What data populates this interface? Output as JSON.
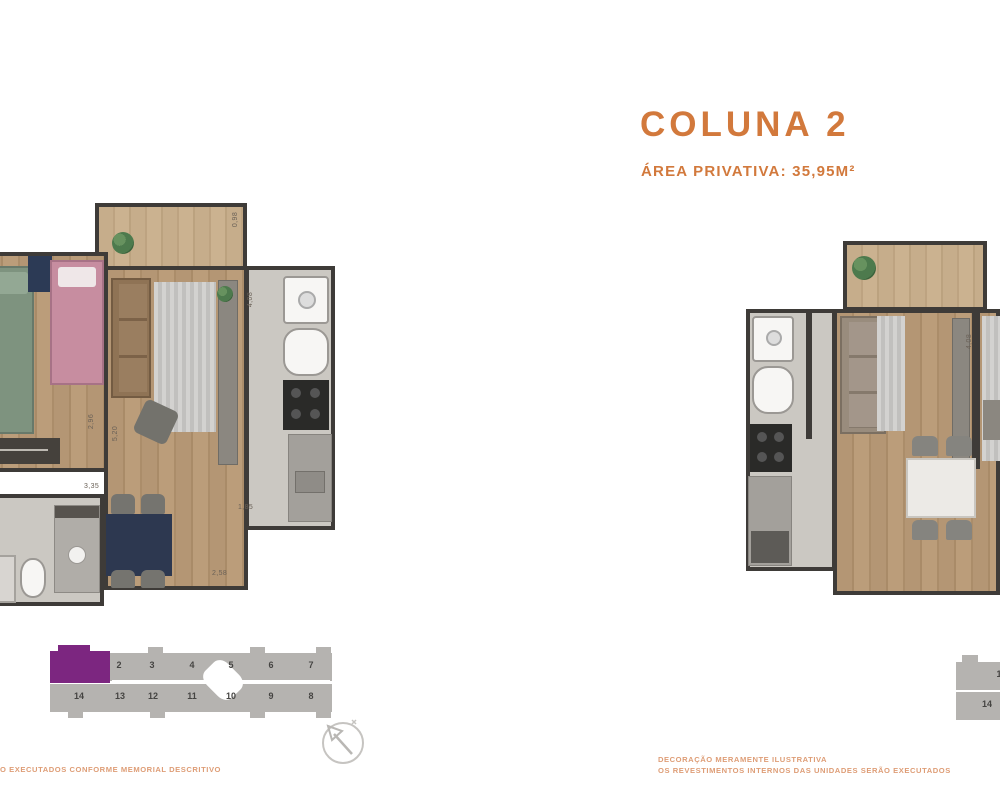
{
  "header": {
    "title": "COLUNA 2",
    "subtitle": "ÁREA PRIVATIVA: 35,95M²"
  },
  "colors": {
    "accent": "#d2793c",
    "note_text": "#de9d76",
    "keyplan_highlight": "#7c2680",
    "keyplan_block": "#b5b3b0",
    "wall": "#3e3b38"
  },
  "left_plan": {
    "dims": {
      "balcony": "0,98",
      "living": "4,08",
      "bedroom": "2,96",
      "hall": "5,20",
      "width": "3,35",
      "step": "1,85",
      "bottom": "2,58"
    }
  },
  "right_plan": {
    "dims": {
      "living": "4,08"
    }
  },
  "keyplan": {
    "top_units": [
      "",
      "2",
      "3",
      "4",
      "5",
      "6",
      "7"
    ],
    "bottom_units": [
      "14",
      "13",
      "12",
      "11",
      "10",
      "9",
      "8"
    ]
  },
  "keyplan_partial": {
    "top": "1",
    "bottom": "14"
  },
  "footer": {
    "left_note": "ÃO EXECUTADOS CONFORME MEMORIAL DESCRITIVO",
    "right_note_1": "DECORAÇÃO MERAMENTE ILUSTRATIVA",
    "right_note_2": "OS REVESTIMENTOS INTERNOS DAS UNIDADES SERÃO EXECUTADOS"
  }
}
